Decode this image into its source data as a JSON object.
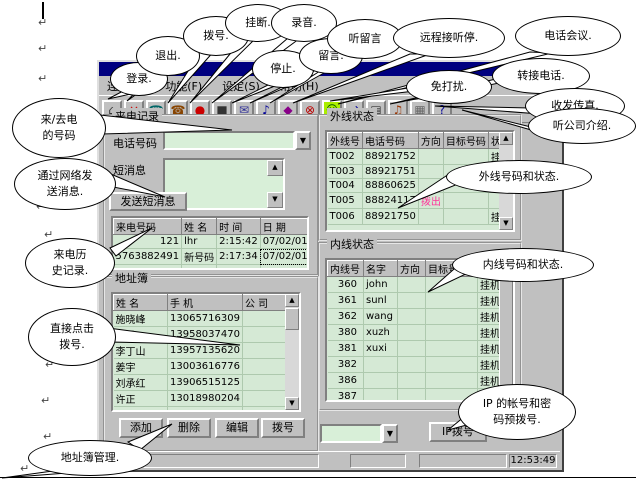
{
  "page": {
    "paragraph_mark": "↵"
  },
  "window": {
    "menu": {
      "items": [
        "连接(C)",
        "功能(F)",
        "设定(S)",
        "帮助(H)"
      ]
    },
    "toolbar": {
      "icons": [
        {
          "name": "login",
          "glyph": "⌂",
          "color": "#333333"
        },
        {
          "name": "exit",
          "glyph": "×",
          "color": "#cc0000"
        },
        {
          "name": "dial",
          "glyph": "☎",
          "color": "#006666"
        },
        {
          "name": "hangup",
          "glyph": "☎",
          "color": "#884400"
        },
        {
          "name": "record",
          "glyph": "●",
          "color": "#cc0000"
        },
        {
          "name": "stop",
          "glyph": "■",
          "color": "#333333"
        },
        {
          "name": "voicemail",
          "glyph": "✉",
          "color": "#333399"
        },
        {
          "name": "listen-voicemail",
          "glyph": "♪",
          "color": "#000099"
        },
        {
          "name": "remote-answer",
          "glyph": "◆",
          "color": "#880088"
        },
        {
          "name": "do-not-disturb",
          "glyph": "⊗",
          "color": "#bb0000"
        },
        {
          "name": "conference",
          "glyph": "☺",
          "color": "#005500",
          "bg": "#aaee00"
        },
        {
          "name": "transfer",
          "glyph": "⇄",
          "color": "#000099"
        },
        {
          "name": "fax",
          "glyph": "▤",
          "color": "#333333"
        },
        {
          "name": "company-intro",
          "glyph": "♫",
          "color": "#993300"
        },
        {
          "name": "settings",
          "glyph": "▦",
          "color": "#666666"
        },
        {
          "name": "help",
          "glyph": "?",
          "color": "#000099"
        }
      ]
    },
    "calls": {
      "title": "来电记录",
      "phone_label": "电话号码",
      "sms_label": "短消息",
      "send_button": "发送短消息",
      "table": {
        "headers": [
          "来电号码",
          "姓  名",
          "时  间",
          "日  期"
        ],
        "rows": [
          [
            "121",
            "lhr",
            "2:15:42",
            "07/02/01"
          ],
          [
            "5763882491",
            "新号码",
            "2:17:34",
            "07/02/01"
          ],
          [
            "5763882491",
            "新号码",
            "2:20:53",
            "07/02/01"
          ]
        ]
      }
    },
    "external": {
      "title": "外线状态",
      "table": {
        "headers": [
          "外线号",
          "电话号码",
          "方向",
          "目标号码",
          "状态"
        ],
        "rows": [
          [
            "T002",
            "88921752",
            "",
            "",
            "挂机"
          ],
          [
            "T003",
            "88921751",
            "",
            "",
            ""
          ],
          [
            "T004",
            "88860625",
            "",
            "",
            ""
          ],
          [
            "T005",
            "88824117",
            "拨出",
            "",
            ""
          ],
          [
            "T006",
            "88921750",
            "",
            "",
            "挂机"
          ]
        ]
      }
    },
    "internal": {
      "title": "内线状态",
      "table": {
        "headers": [
          "内线号",
          "名字",
          "方向",
          "目标号码",
          "状态"
        ],
        "rows": [
          [
            "360",
            "john",
            "",
            "",
            "挂机"
          ],
          [
            "361",
            "sunl",
            "",
            "",
            "挂机"
          ],
          [
            "362",
            "wang",
            "",
            "",
            "挂机"
          ],
          [
            "380",
            "xuzh",
            "",
            "",
            "挂机"
          ],
          [
            "381",
            "xuxi",
            "",
            "",
            "挂机"
          ],
          [
            "382",
            "",
            "",
            "",
            "挂机"
          ],
          [
            "386",
            "",
            "",
            "",
            "挂机"
          ],
          [
            "387",
            "",
            "",
            "",
            "挂机"
          ],
          [
            "388",
            "",
            "",
            "",
            "挂机"
          ]
        ]
      }
    },
    "addressbook": {
      "title": "地址簿",
      "table": {
        "headers": [
          "姓  名",
          "手  机",
          "公  司"
        ],
        "rows": [
          [
            "施晓峰",
            "13065716309",
            ""
          ],
          [
            "高民",
            "13958037470",
            ""
          ],
          [
            "李丁山",
            "13957135620",
            ""
          ],
          [
            "姜宇",
            "13003616776",
            ""
          ],
          [
            "刘承红",
            "13906515125",
            ""
          ],
          [
            "许正",
            "13018980204",
            ""
          ],
          [
            "徐翔",
            "13018955581",
            "星际网络"
          ]
        ]
      },
      "buttons": [
        "添加",
        "删除",
        "编辑",
        "拨号"
      ]
    },
    "ipdial": {
      "button": "IP拨号"
    },
    "statusbar": {
      "time": "12:53:49"
    }
  },
  "colors": {
    "titlebar": "#000080",
    "table_green": "#d5e9d5",
    "dial_out_pink": "#ff3399"
  },
  "callouts": [
    {
      "name": "login",
      "text": "登录."
    },
    {
      "name": "exit",
      "text": "退出."
    },
    {
      "name": "dial",
      "text": "拨号."
    },
    {
      "name": "hangup",
      "text": "挂断."
    },
    {
      "name": "record",
      "text": "录音."
    },
    {
      "name": "stop",
      "text": "停止."
    },
    {
      "name": "voicemail",
      "text": "留言."
    },
    {
      "name": "listen-voicemail",
      "text": "听留言"
    },
    {
      "name": "remote-answer",
      "text": "远程接听停."
    },
    {
      "name": "conference",
      "text": "电话会议."
    },
    {
      "name": "do-not-disturb",
      "text": "免打扰."
    },
    {
      "name": "transfer-call",
      "text": "转接电话."
    },
    {
      "name": "fax",
      "text": "收发传真."
    },
    {
      "name": "company-intro",
      "text": "听公司介绍."
    },
    {
      "name": "caller-number",
      "text": "来/去电\n的号码"
    },
    {
      "name": "net-message",
      "text": "通过网络发\n送消息."
    },
    {
      "name": "call-history",
      "text": "来电历\n史记录."
    },
    {
      "name": "click-dial",
      "text": "直接点击\n拨号."
    },
    {
      "name": "addressbook-manage",
      "text": "地址簿管理."
    },
    {
      "name": "external-status",
      "text": "外线号码和状态."
    },
    {
      "name": "internal-status",
      "text": "内线号码和状态."
    },
    {
      "name": "ip-account-dial",
      "text": "IP 的帐号和密\n码预拨号."
    }
  ]
}
